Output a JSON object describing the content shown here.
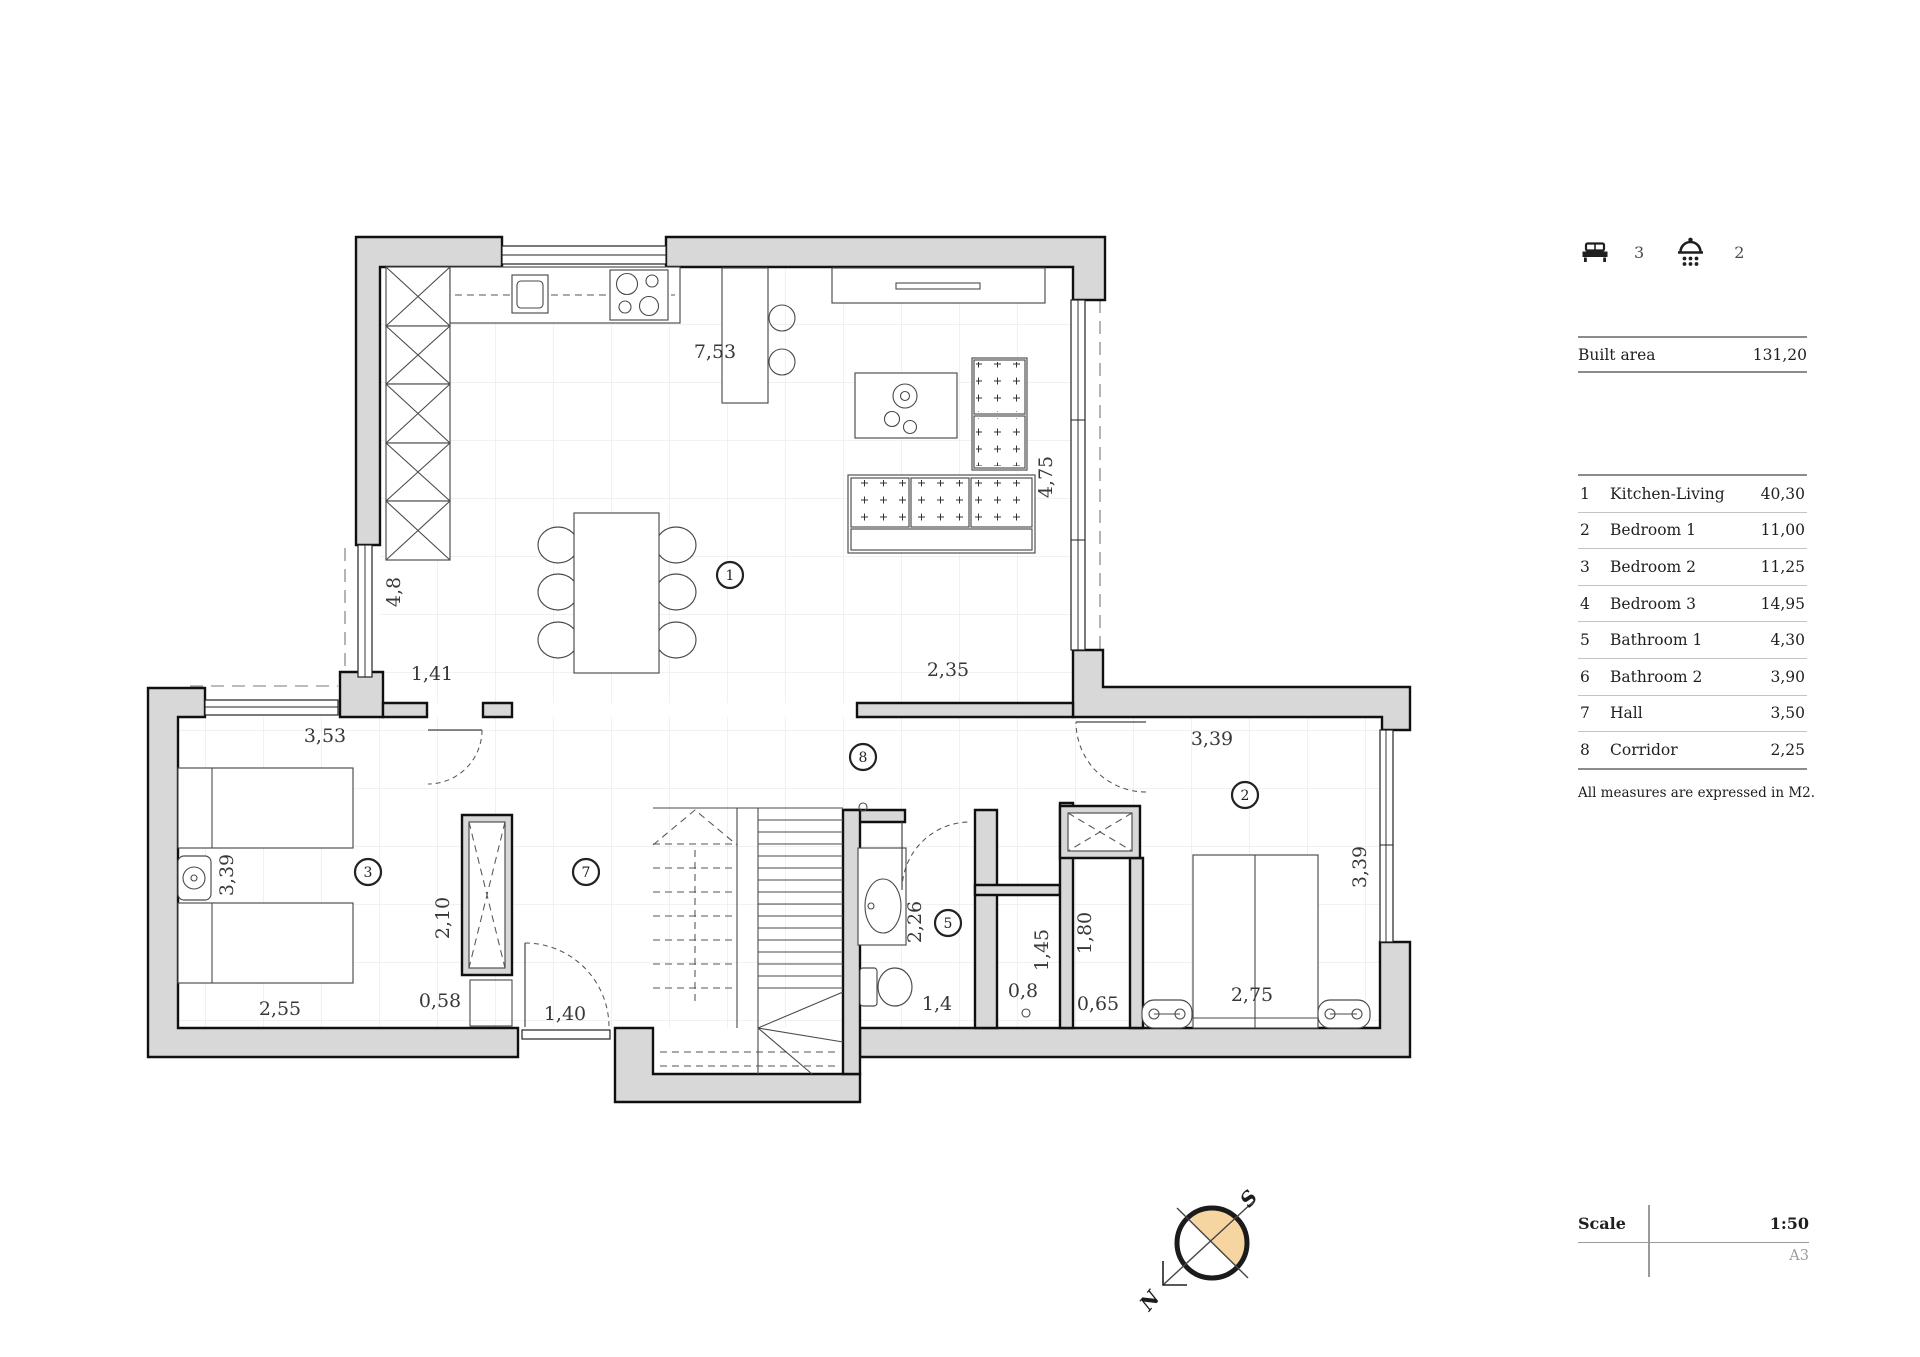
{
  "panel": {
    "beds": {
      "icon": "bed-icon",
      "count": "3"
    },
    "showers": {
      "icon": "shower-icon",
      "count": "2"
    },
    "built_area": {
      "label": "Built area",
      "value": "131,20"
    },
    "rooms": [
      {
        "num": "1",
        "name": "Kitchen-Living",
        "area": "40,30"
      },
      {
        "num": "2",
        "name": "Bedroom 1",
        "area": "11,00"
      },
      {
        "num": "3",
        "name": "Bedroom 2",
        "area": "11,25"
      },
      {
        "num": "4",
        "name": "Bedroom 3",
        "area": "14,95"
      },
      {
        "num": "5",
        "name": "Bathroom 1",
        "area": "4,30"
      },
      {
        "num": "6",
        "name": "Bathroom 2",
        "area": "3,90"
      },
      {
        "num": "7",
        "name": "Hall",
        "area": "3,50"
      },
      {
        "num": "8",
        "name": "Corridor",
        "area": "2,25"
      }
    ],
    "footnote": "All measures are expressed in M2.",
    "scale": {
      "label": "Scale",
      "value": "1:50",
      "paper_size": "A3"
    }
  },
  "compass": {
    "north_label": "N",
    "south_label": "S",
    "fill": "#f6d5a0"
  },
  "plan": {
    "room_markers": [
      {
        "n": "1",
        "x": 730,
        "y": 575
      },
      {
        "n": "8",
        "x": 863,
        "y": 757
      },
      {
        "n": "7",
        "x": 586,
        "y": 872
      },
      {
        "n": "3",
        "x": 368,
        "y": 872
      },
      {
        "n": "5",
        "x": 948,
        "y": 923
      },
      {
        "n": "2",
        "x": 1245,
        "y": 795
      }
    ],
    "dimensions": [
      {
        "t": "7,53",
        "x": 715,
        "y": 358,
        "rot": 0
      },
      {
        "t": "4,75",
        "x": 1052,
        "y": 477,
        "rot": -90
      },
      {
        "t": "4,8",
        "x": 400,
        "y": 592,
        "rot": -90
      },
      {
        "t": "1,41",
        "x": 432,
        "y": 680,
        "rot": 0
      },
      {
        "t": "2,35",
        "x": 948,
        "y": 676,
        "rot": 0
      },
      {
        "t": "3,53",
        "x": 325,
        "y": 742,
        "rot": 0
      },
      {
        "t": "3,39",
        "x": 1212,
        "y": 745,
        "rot": 0
      },
      {
        "t": "3,39",
        "x": 1366,
        "y": 867,
        "rot": -90
      },
      {
        "t": "3,39",
        "x": 233,
        "y": 875,
        "rot": -90
      },
      {
        "t": "2,10",
        "x": 449,
        "y": 918,
        "rot": -90
      },
      {
        "t": "2,26",
        "x": 921,
        "y": 922,
        "rot": -90
      },
      {
        "t": "1,45",
        "x": 1048,
        "y": 950,
        "rot": -90
      },
      {
        "t": "1,80",
        "x": 1091,
        "y": 933,
        "rot": -90
      },
      {
        "t": "0,8",
        "x": 1023,
        "y": 997,
        "rot": 0
      },
      {
        "t": "2,75",
        "x": 1252,
        "y": 1001,
        "rot": 0
      },
      {
        "t": "0,58",
        "x": 440,
        "y": 1007,
        "rot": 0
      },
      {
        "t": "0,65",
        "x": 1098,
        "y": 1010,
        "rot": 0
      },
      {
        "t": "1,4",
        "x": 937,
        "y": 1010,
        "rot": 0
      },
      {
        "t": "2,55",
        "x": 280,
        "y": 1015,
        "rot": 0
      },
      {
        "t": "1,40",
        "x": 565,
        "y": 1020,
        "rot": 0
      }
    ]
  }
}
